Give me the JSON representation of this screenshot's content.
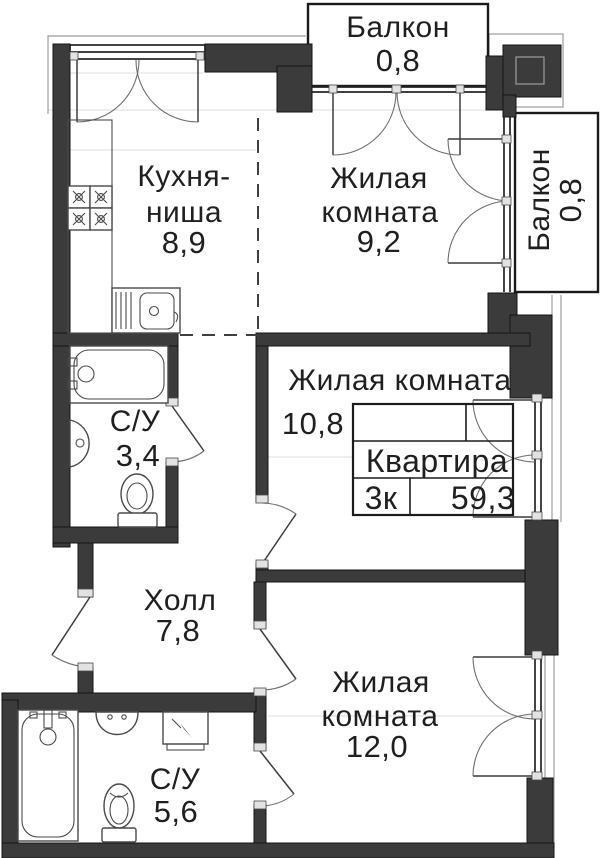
{
  "rooms": {
    "balcony_top": {
      "name": "Балкон",
      "area": "0,8"
    },
    "kitchen": {
      "name_line1": "Кухня-",
      "name_line2": "ниша",
      "area": "8,9"
    },
    "living_top": {
      "name_line1": "Жилая",
      "name_line2": "комната",
      "area": "9,2"
    },
    "balcony_right": {
      "name": "Балкон",
      "area": "0,8"
    },
    "living_mid": {
      "name": "Жилая комната",
      "area": "10,8"
    },
    "bathroom_small": {
      "name": "С/У",
      "area": "3,4"
    },
    "hall": {
      "name": "Холл",
      "area": "7,8"
    },
    "living_bottom": {
      "name_line1": "Жилая",
      "name_line2": "комната",
      "area": "12,0"
    },
    "bathroom_large": {
      "name": "С/У",
      "area": "5,6"
    }
  },
  "stamp": {
    "label": "Квартира",
    "rooms_count": "3к",
    "total_area": "59,3"
  },
  "colors": {
    "wall": "#3b3b3b",
    "text": "#1f1f1f",
    "outline": "#1a1a1a",
    "background": "#ffffff"
  }
}
